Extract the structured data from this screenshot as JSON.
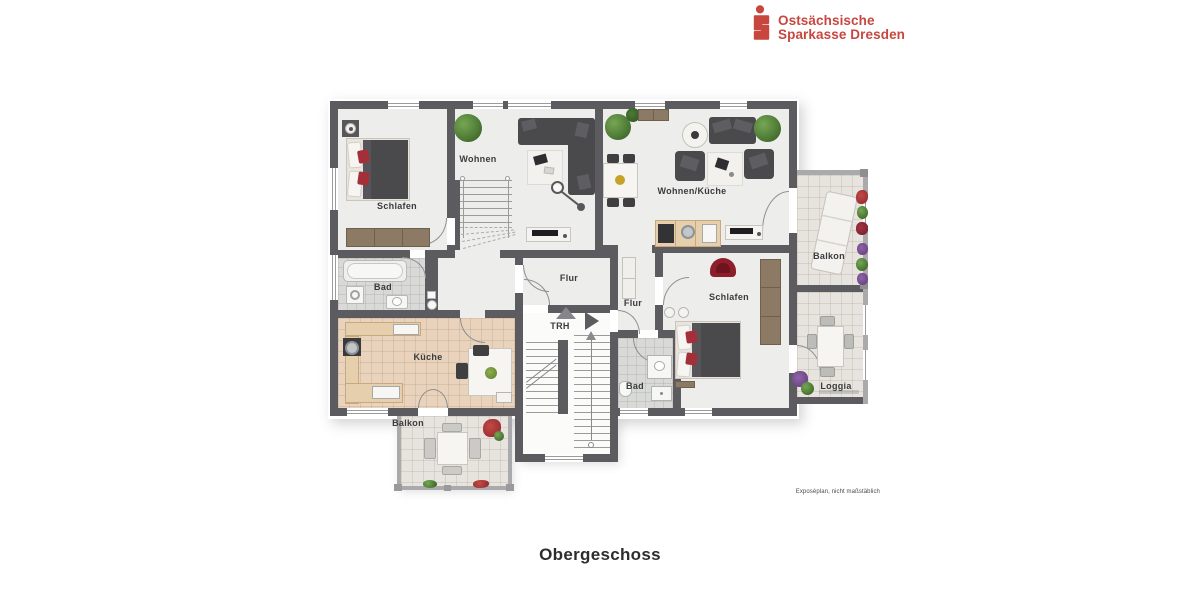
{
  "header": {
    "logo": {
      "icon": "sparkasse-s-icon",
      "line1": "Ostsächsische",
      "line2": "Sparkasse Dresden",
      "color": "#c7473f"
    }
  },
  "plan": {
    "palette": {
      "wall": "#5b5b60",
      "wall_light": "#aaa9ac",
      "floor": "#edeeec",
      "stairwell_floor": "#fbfbfa",
      "tile_beige": "#e9d3bc",
      "tile_gray": "#d8dad9",
      "tile_outdoor": "#e7e4df",
      "furniture_dark": "#4a4a4d",
      "furniture_light": "#f4f3f0",
      "wood": "#8d7a64",
      "counter_beige": "#e6cfad",
      "accent_red": "#a42f38",
      "chair_red": "#8e1f2a",
      "plant_green": "#4d7a36",
      "line": "#9b9b9b",
      "label": "#3b3b3d"
    },
    "labels": {
      "wohnen": "Wohnen",
      "schlafen_left": "Schlafen",
      "wohnen_kueche": "Wohnen/Küche",
      "balkon_right": "Balkon",
      "bad_left": "Bad",
      "flur_center": "Flur",
      "flur_right": "Flur",
      "schlafen_right": "Schlafen",
      "trh": "TRH",
      "kueche": "Küche",
      "bad_right": "Bad",
      "loggia": "Loggia",
      "balkon_bottom": "Balkon"
    },
    "disclaimer": "Exposéplan, nicht maßstäblich"
  },
  "caption": {
    "title": "Obergeschoss"
  }
}
